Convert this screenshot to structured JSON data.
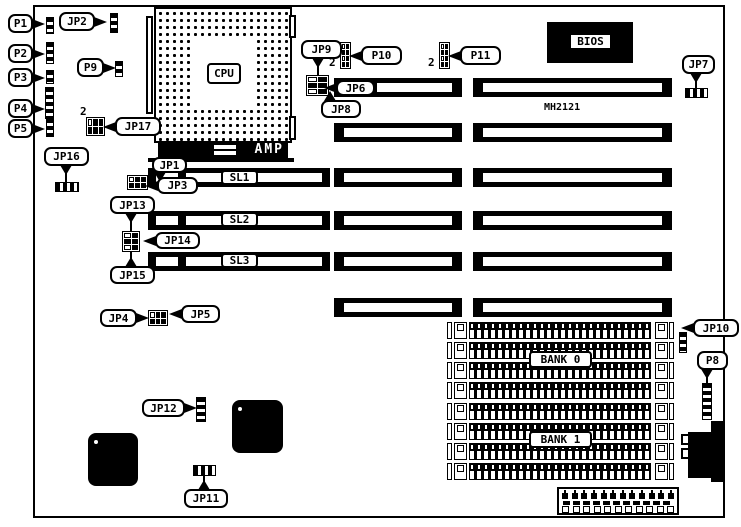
{
  "diagram": {
    "model_text": "MH2121"
  },
  "cpu": {
    "label": "CPU",
    "amp": "AMP"
  },
  "bios": {
    "label": "BIOS"
  },
  "boxed_labels": [
    {
      "id": "sl1",
      "label": "SL1",
      "x": 221,
      "y": 170,
      "w": 37,
      "h": 15
    },
    {
      "id": "sl2",
      "label": "SL2",
      "x": 221,
      "y": 212,
      "w": 37,
      "h": 15
    },
    {
      "id": "sl3",
      "label": "SL3",
      "x": 221,
      "y": 253,
      "w": 37,
      "h": 15
    },
    {
      "id": "bank-0",
      "label": "BANK 0",
      "x": 529,
      "y": 351,
      "w": 63,
      "h": 17
    },
    {
      "id": "bank-1",
      "label": "BANK 1",
      "x": 529,
      "y": 431,
      "w": 63,
      "h": 17
    }
  ],
  "free_texts": [
    {
      "id": "model",
      "text": "MH2121",
      "x": 544,
      "y": 103,
      "size": 10
    },
    {
      "id": "pin2-jp17",
      "text": "2",
      "x": 80,
      "y": 106,
      "size": 11
    },
    {
      "id": "pin2-p10",
      "text": "2",
      "x": 329,
      "y": 57,
      "size": 11
    },
    {
      "id": "pin2-p11",
      "text": "2",
      "x": 428,
      "y": 57,
      "size": 11
    }
  ],
  "callouts": [
    {
      "id": "p1",
      "label": "P1",
      "x": 8,
      "y": 14,
      "w": 25,
      "h": 19,
      "arrow": "right"
    },
    {
      "id": "jp2",
      "label": "JP2",
      "x": 59,
      "y": 12,
      "w": 36,
      "h": 19,
      "arrow": "right"
    },
    {
      "id": "p2",
      "label": "P2",
      "x": 8,
      "y": 44,
      "w": 25,
      "h": 19,
      "arrow": "right"
    },
    {
      "id": "p9",
      "label": "P9",
      "x": 77,
      "y": 58,
      "w": 27,
      "h": 19,
      "arrow": "right"
    },
    {
      "id": "p3",
      "label": "P3",
      "x": 8,
      "y": 68,
      "w": 25,
      "h": 19,
      "arrow": "right"
    },
    {
      "id": "p4",
      "label": "P4",
      "x": 8,
      "y": 99,
      "w": 25,
      "h": 19,
      "arrow": "right"
    },
    {
      "id": "p5",
      "label": "P5",
      "x": 8,
      "y": 119,
      "w": 25,
      "h": 19,
      "arrow": "right"
    },
    {
      "id": "jp17",
      "label": "JP17",
      "x": 115,
      "y": 117,
      "w": 46,
      "h": 19,
      "arrow": "left"
    },
    {
      "id": "jp16",
      "label": "JP16",
      "x": 44,
      "y": 147,
      "w": 45,
      "h": 19,
      "arrow": "down",
      "ax": 66
    },
    {
      "id": "jp1",
      "label": "JP1",
      "x": 152,
      "y": 157,
      "w": 35,
      "h": 16,
      "arrow": "down",
      "ax": 160
    },
    {
      "id": "jp3",
      "label": "JP3",
      "x": 157,
      "y": 177,
      "w": 41,
      "h": 17,
      "arrow": "left"
    },
    {
      "id": "jp13",
      "label": "JP13",
      "x": 110,
      "y": 196,
      "w": 45,
      "h": 18,
      "arrow": "down",
      "ax": 131
    },
    {
      "id": "jp14",
      "label": "JP14",
      "x": 155,
      "y": 232,
      "w": 45,
      "h": 17,
      "arrow": "left"
    },
    {
      "id": "jp15",
      "label": "JP15",
      "x": 110,
      "y": 266,
      "w": 45,
      "h": 18,
      "arrow": "up",
      "ax": 131
    },
    {
      "id": "jp4",
      "label": "JP4",
      "x": 100,
      "y": 309,
      "w": 37,
      "h": 18,
      "arrow": "right"
    },
    {
      "id": "jp5",
      "label": "JP5",
      "x": 181,
      "y": 305,
      "w": 39,
      "h": 18,
      "arrow": "left"
    },
    {
      "id": "jp9",
      "label": "JP9",
      "x": 301,
      "y": 40,
      "w": 41,
      "h": 19,
      "arrow": "down",
      "ax": 318
    },
    {
      "id": "jp6",
      "label": "JP6",
      "x": 336,
      "y": 80,
      "w": 39,
      "h": 16,
      "arrow": "left"
    },
    {
      "id": "jp8",
      "label": "JP8",
      "x": 321,
      "y": 100,
      "w": 40,
      "h": 18,
      "arrow": "up",
      "ax": 330
    },
    {
      "id": "p10",
      "label": "P10",
      "x": 361,
      "y": 46,
      "w": 41,
      "h": 19,
      "arrow": "left"
    },
    {
      "id": "p11",
      "label": "P11",
      "x": 460,
      "y": 46,
      "w": 41,
      "h": 19,
      "arrow": "left"
    },
    {
      "id": "jp7",
      "label": "JP7",
      "x": 682,
      "y": 55,
      "w": 33,
      "h": 19,
      "arrow": "down",
      "ax": 696
    },
    {
      "id": "jp10",
      "label": "JP10",
      "x": 693,
      "y": 319,
      "w": 46,
      "h": 18,
      "arrow": "left"
    },
    {
      "id": "p8",
      "label": "P8",
      "x": 697,
      "y": 351,
      "w": 31,
      "h": 19,
      "arrow": "down",
      "ax": 707
    },
    {
      "id": "jp12",
      "label": "JP12",
      "x": 142,
      "y": 399,
      "w": 43,
      "h": 18,
      "arrow": "right"
    },
    {
      "id": "jp11",
      "label": "JP11",
      "x": 184,
      "y": 489,
      "w": 44,
      "h": 19,
      "arrow": "up",
      "ax": 204
    }
  ],
  "connectors": [
    {
      "id": "p1",
      "x": 46,
      "y": 17,
      "w": 8,
      "h": 17,
      "type": "strip-v"
    },
    {
      "id": "jp2",
      "x": 110,
      "y": 13,
      "w": 8,
      "h": 20,
      "type": "strip-v"
    },
    {
      "id": "p2",
      "x": 46,
      "y": 42,
      "w": 8,
      "h": 22,
      "type": "strip-v"
    },
    {
      "id": "p9",
      "x": 115,
      "y": 61,
      "w": 8,
      "h": 16,
      "type": "strip-v"
    },
    {
      "id": "p3",
      "x": 46,
      "y": 70,
      "w": 8,
      "h": 14,
      "type": "strip-v"
    },
    {
      "id": "p4",
      "x": 45,
      "y": 87,
      "w": 9,
      "h": 32,
      "type": "strip-v"
    },
    {
      "id": "p5",
      "x": 46,
      "y": 118,
      "w": 8,
      "h": 19,
      "type": "strip-v"
    },
    {
      "id": "jp17",
      "x": 86,
      "y": 117,
      "w": 19,
      "h": 19,
      "type": "block",
      "cols": 3,
      "rows": 2
    },
    {
      "id": "jp16",
      "x": 55,
      "y": 182,
      "w": 24,
      "h": 10,
      "type": "strip-h"
    },
    {
      "id": "jp1",
      "x": 127,
      "y": 175,
      "w": 21,
      "h": 15,
      "type": "block",
      "cols": 3,
      "rows": 2
    },
    {
      "id": "jp13",
      "x": 122,
      "y": 231,
      "w": 18,
      "h": 21,
      "type": "block",
      "cols": 2,
      "rows": 3
    },
    {
      "id": "jp4",
      "x": 148,
      "y": 310,
      "w": 20,
      "h": 16,
      "type": "block",
      "cols": 3,
      "rows": 2
    },
    {
      "id": "jp9",
      "x": 306,
      "y": 75,
      "w": 23,
      "h": 21,
      "type": "block",
      "cols": 2,
      "rows": 3
    },
    {
      "id": "p10",
      "x": 340,
      "y": 42,
      "w": 11,
      "h": 27,
      "type": "block",
      "cols": 2,
      "rows": 4
    },
    {
      "id": "p11",
      "x": 439,
      "y": 42,
      "w": 11,
      "h": 27,
      "type": "block",
      "cols": 2,
      "rows": 4
    },
    {
      "id": "jp7",
      "x": 685,
      "y": 88,
      "w": 23,
      "h": 10,
      "type": "strip-h"
    },
    {
      "id": "jp10",
      "x": 679,
      "y": 332,
      "w": 8,
      "h": 21,
      "type": "strip-v"
    },
    {
      "id": "p8",
      "x": 702,
      "y": 383,
      "w": 10,
      "h": 37,
      "type": "strip-v"
    },
    {
      "id": "jp12",
      "x": 196,
      "y": 397,
      "w": 10,
      "h": 25,
      "type": "strip-v"
    },
    {
      "id": "jp11",
      "x": 193,
      "y": 465,
      "w": 23,
      "h": 11,
      "type": "strip-h"
    }
  ],
  "stems": [
    {
      "x": 65,
      "y": 166,
      "w": 2,
      "h": 17
    },
    {
      "x": 130,
      "y": 213,
      "w": 2,
      "h": 19
    },
    {
      "x": 130,
      "y": 251,
      "w": 2,
      "h": 16
    },
    {
      "x": 317,
      "y": 58,
      "w": 2,
      "h": 18
    },
    {
      "x": 695,
      "y": 73,
      "w": 2,
      "h": 16
    },
    {
      "x": 706,
      "y": 369,
      "w": 2,
      "h": 15
    },
    {
      "x": 203,
      "y": 475,
      "w": 2,
      "h": 15
    }
  ],
  "slots": {
    "h": 19,
    "rows": [
      {
        "y": 78,
        "segments": [
          {
            "x": 334,
            "w": 128,
            "inner": [
              {
                "x": 377,
                "w": 75
              }
            ]
          },
          {
            "x": 473,
            "w": 199,
            "inner": [
              {
                "x": 483,
                "w": 179
              }
            ]
          }
        ]
      },
      {
        "y": 123,
        "segments": [
          {
            "x": 334,
            "w": 128,
            "inner": [
              {
                "x": 344,
                "w": 108
              }
            ]
          },
          {
            "x": 473,
            "w": 199,
            "inner": [
              {
                "x": 483,
                "w": 179
              }
            ]
          }
        ]
      },
      {
        "y": 168,
        "segments": [
          {
            "x": 148,
            "w": 182,
            "inner": [
              {
                "x": 156,
                "w": 22
              },
              {
                "x": 186,
                "w": 136
              }
            ]
          },
          {
            "x": 334,
            "w": 128,
            "inner": [
              {
                "x": 344,
                "w": 108
              }
            ]
          },
          {
            "x": 473,
            "w": 199,
            "inner": [
              {
                "x": 483,
                "w": 179
              }
            ]
          }
        ]
      },
      {
        "y": 211,
        "segments": [
          {
            "x": 148,
            "w": 182,
            "inner": [
              {
                "x": 156,
                "w": 22
              },
              {
                "x": 186,
                "w": 136
              }
            ]
          },
          {
            "x": 334,
            "w": 128,
            "inner": [
              {
                "x": 344,
                "w": 108
              }
            ]
          },
          {
            "x": 473,
            "w": 199,
            "inner": [
              {
                "x": 483,
                "w": 179
              }
            ]
          }
        ]
      },
      {
        "y": 252,
        "segments": [
          {
            "x": 148,
            "w": 182,
            "inner": [
              {
                "x": 156,
                "w": 22
              },
              {
                "x": 186,
                "w": 136
              }
            ]
          },
          {
            "x": 334,
            "w": 128,
            "inner": [
              {
                "x": 344,
                "w": 108
              }
            ]
          },
          {
            "x": 473,
            "w": 199,
            "inner": [
              {
                "x": 483,
                "w": 179
              }
            ]
          }
        ]
      },
      {
        "y": 298,
        "segments": [
          {
            "x": 334,
            "w": 128,
            "inner": [
              {
                "x": 344,
                "w": 108
              }
            ]
          },
          {
            "x": 473,
            "w": 199,
            "inner": [
              {
                "x": 483,
                "w": 179
              }
            ]
          }
        ]
      }
    ]
  },
  "simm": {
    "x": 447,
    "w": 227,
    "h": 17,
    "ys": [
      322,
      342,
      362,
      382,
      403,
      423,
      443,
      463
    ]
  },
  "chips": [
    {
      "x": 88,
      "y": 433,
      "w": 50,
      "h": 53
    },
    {
      "x": 232,
      "y": 400,
      "w": 51,
      "h": 53
    }
  ],
  "power": {
    "top_pins": 12,
    "bottom_slots": 11
  },
  "colors": {
    "ink": "#000000",
    "paper": "#ffffff"
  }
}
